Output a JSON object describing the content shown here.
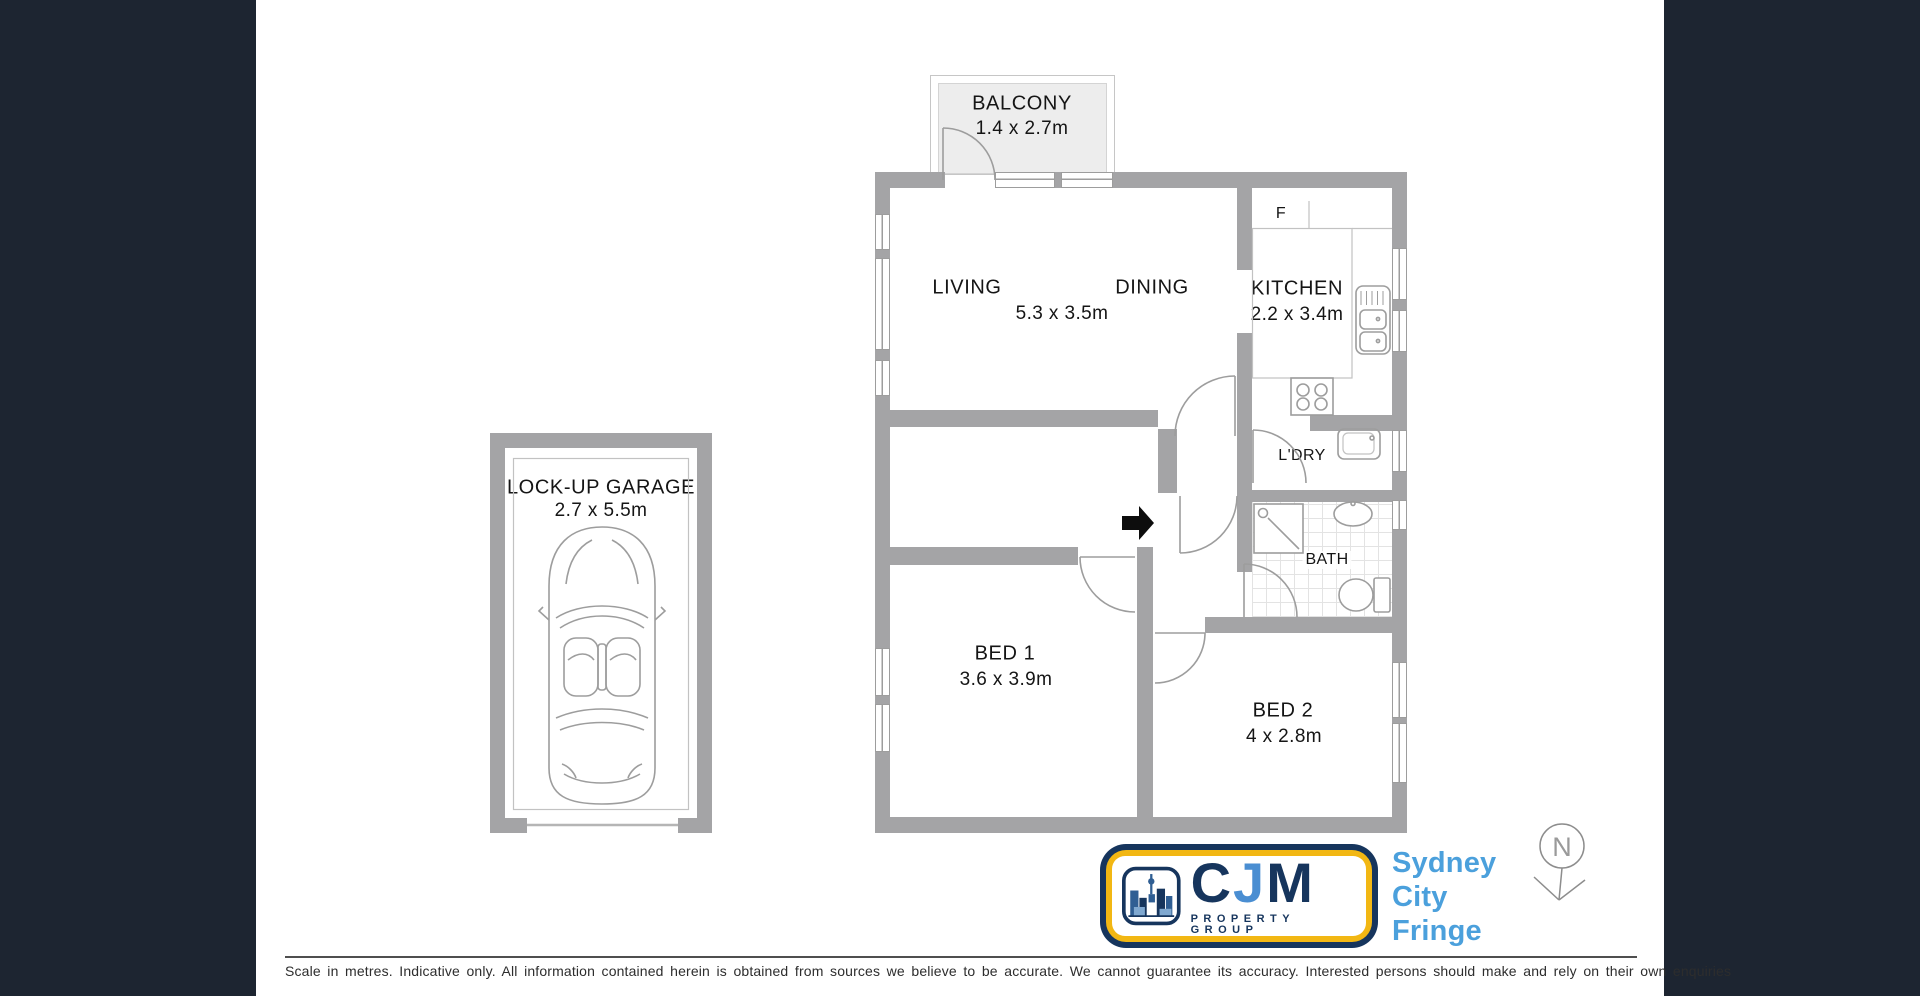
{
  "colors": {
    "panel_dark": "#1d2531",
    "wall_gray": "#a4a4a6",
    "line_gray": "#9d9d9d",
    "logo_navy": "#16355d",
    "logo_gold": "#f2b713",
    "logo_blue": "#4a8ed2",
    "region_blue": "#4ba0dc"
  },
  "plan": {
    "balcony": {
      "label": "BALCONY",
      "dims": "1.4 x 2.7m"
    },
    "living": {
      "label": "LIVING"
    },
    "dining": {
      "label": "DINING"
    },
    "living_dining": {
      "dims": "5.3 x 3.5m"
    },
    "kitchen": {
      "label": "KITCHEN",
      "dims": "2.2 x 3.4m"
    },
    "fridge": {
      "label": "F"
    },
    "laundry": {
      "label": "L'DRY"
    },
    "bath": {
      "label": "BATH"
    },
    "bed1": {
      "label": "BED 1",
      "dims": "3.6 x 3.9m"
    },
    "bed2": {
      "label": "BED 2",
      "dims": "4 x 2.8m"
    },
    "garage": {
      "label": "LOCK-UP GARAGE",
      "dims": "2.7 x 5.5m"
    }
  },
  "compass": {
    "label": "N"
  },
  "branding": {
    "logo": {
      "letter_c": "C",
      "letter_j": "J",
      "letter_m": "M",
      "subtitle": "PROPERTY GROUP"
    },
    "region_lines": [
      "Sydney",
      "City",
      "Fringe"
    ]
  },
  "footer": {
    "disclaimer": "Scale in metres. Indicative only. All information contained herein is obtained from sources we believe to be accurate. We cannot guarantee its accuracy. Interested persons should make and rely on their own enquiries"
  }
}
